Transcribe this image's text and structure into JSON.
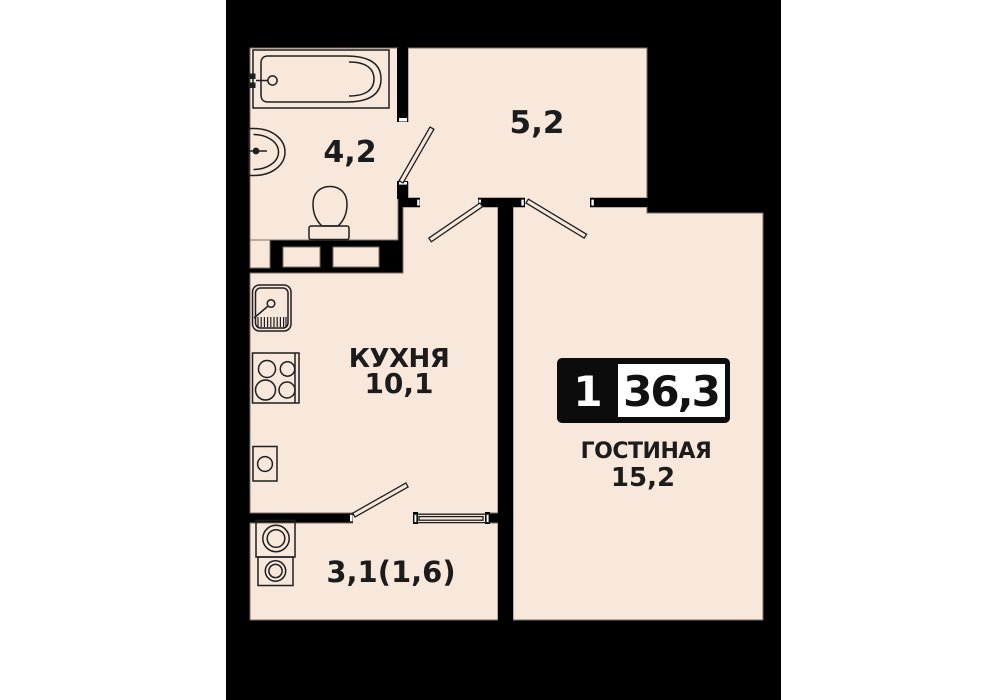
{
  "floorplan": {
    "badge": {
      "rooms_count": "1",
      "total_area": "36,3"
    },
    "rooms": {
      "bathroom": {
        "area": "4,2"
      },
      "hallway": {
        "area": "5,2"
      },
      "kitchen": {
        "name": "КУХНЯ",
        "area": "10,1"
      },
      "living_room": {
        "name": "ГОСТИНАЯ",
        "area": "15,2"
      },
      "balcony": {
        "area": "3,1(1,6)"
      }
    },
    "fixtures": [
      "bathtub",
      "wash-basin",
      "toilet",
      "kitchen-sink",
      "stove",
      "water-heater",
      "washing-machine",
      "dryer"
    ],
    "colors": {
      "page_background": "#FFFFFF",
      "wall_black": "#000000",
      "floor_cream": "#F8E7DB",
      "floor_edge": "#7D6E63",
      "fixture_line": "#1F1F1F",
      "badge_background": "#0C0C0C",
      "badge_box": "#FFFFFF",
      "label_text": "#1C1C1C"
    }
  }
}
